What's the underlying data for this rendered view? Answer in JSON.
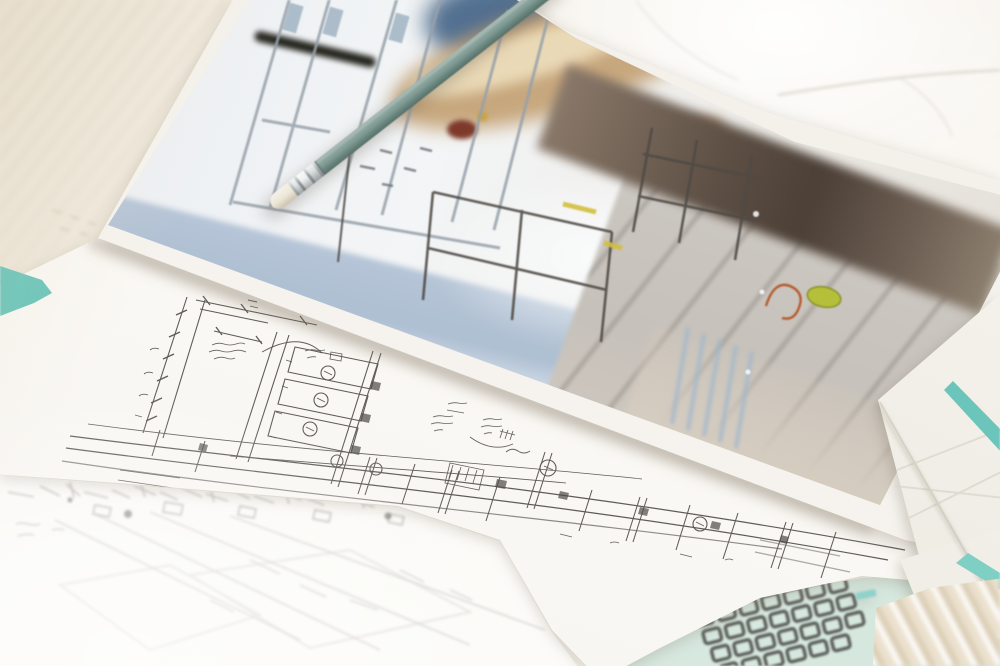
{
  "scene": {
    "type": "photograph",
    "setting": "Close-up of architectural design documents on a white marble desk: a printed interior rendering lies upside-down across hand-drawn pencil sketches, with a sage-green pencil resting on top; teal-trimmed folders, a mint folder with a dark wire grid, and beige cloth peek in at the edges.",
    "focus": "shallow depth of field; the hand-drawn plan is sharpest, print and foreground are blurred"
  },
  "objects": {
    "marble_desk": {
      "name": "marble desk surface",
      "base_color": "#f3eee6",
      "vein_color": "#c9c2b5"
    },
    "photo_print": {
      "name": "printed interior rendering laid upside-down",
      "paper_color": "#f5f2ec",
      "notable_contents": [
        "white glass door frames",
        "blurred tan wooden furniture",
        "dark walnut shadow band",
        "gray tiled floor",
        "steel-blue floor reflection",
        "black handle bar",
        "navy blur",
        "orange wire decor piece",
        "chartreuse object",
        "yellow fittings",
        "thin dark chair and table frames"
      ],
      "accent_colors": {
        "steel_blue": "#aebfd2",
        "tan_wood": "#c7a77d",
        "dark_walnut": "#5d4f44",
        "floor_gray": "#cbc7c1",
        "orange": "#b55a2c",
        "chartreuse": "#b5bf3a",
        "navy": "#35587e",
        "yellow": "#d3bf3e"
      }
    },
    "pencil": {
      "name": "sage-green drafting pencil with silver ferrule and cream eraser",
      "body_color": "#7e9a93",
      "ferrule_color": "#ccd1d2",
      "eraser_color": "#ece6d8"
    },
    "plan_sketch": {
      "name": "hand-drawn cabinet elevation and wall-section sketch",
      "paper_color": "#f8f5f0",
      "graphite_color": "#4e4b47",
      "features": [
        "dimension strings with tick marks",
        "three stacked cabinet boxes with circled fixture tags",
        "long baseline wall-section rows",
        "filled column hatches",
        "handwritten annotations (upside-down, illegible)",
        "leader arcs and hatched arrow"
      ],
      "circled_tag_count": 7
    },
    "site_sketch": {
      "name": "out-of-focus perspective site sketch",
      "paper_color": "#f7f5f2",
      "graphite_color": "#8f8b86"
    },
    "teal_folder_corner": {
      "name": "teal folder corner peeking at left edge",
      "color": "#6fc7bd"
    },
    "trimmed_sheets": {
      "name": "white sheets with teal trim at right edge",
      "trim_color": "#6cc5bb"
    },
    "mint_folder": {
      "name": "mint folder at bottom right",
      "color": "#dcebe3"
    },
    "wire_grid": {
      "name": "dark wire grid rack on mint folder",
      "color": "#3c3b37"
    },
    "fabric": {
      "name": "crumpled beige cloth at bottom-right corner",
      "color": "#e8decb"
    }
  }
}
